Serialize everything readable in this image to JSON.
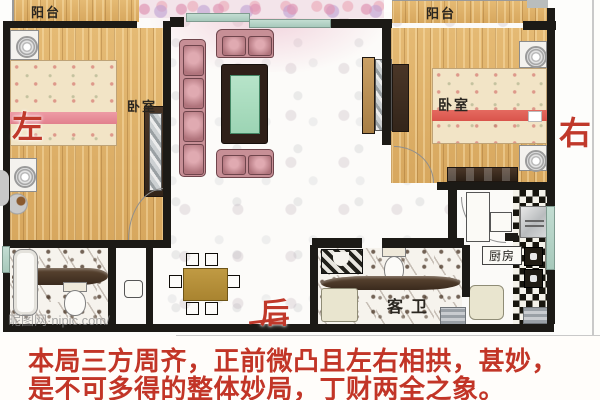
{
  "rooms": {
    "balcony_left": "阳台",
    "balcony_right": "阳台",
    "bedroom_left": "卧室",
    "bedroom_right": "卧室",
    "guest_bathroom": "客卫",
    "kitchen": "厨房"
  },
  "directions": {
    "left": "左",
    "right": "右",
    "back": "后"
  },
  "watermark": "昵图网·nipic.com/",
  "caption": {
    "line1": "本局三方周齐，正前微凸且左右相拱，甚妙，",
    "line2": "是不可多得的整体妙局，丁财两全之象。"
  },
  "colors": {
    "wall": "#1c1a16",
    "wood_floor": "#ddb06a",
    "annotation_red": "#c0392b",
    "sofa_pink": "#c78f96",
    "coffee_table_green": "#a8dcc1",
    "window_teal": "#b7d6c9"
  }
}
